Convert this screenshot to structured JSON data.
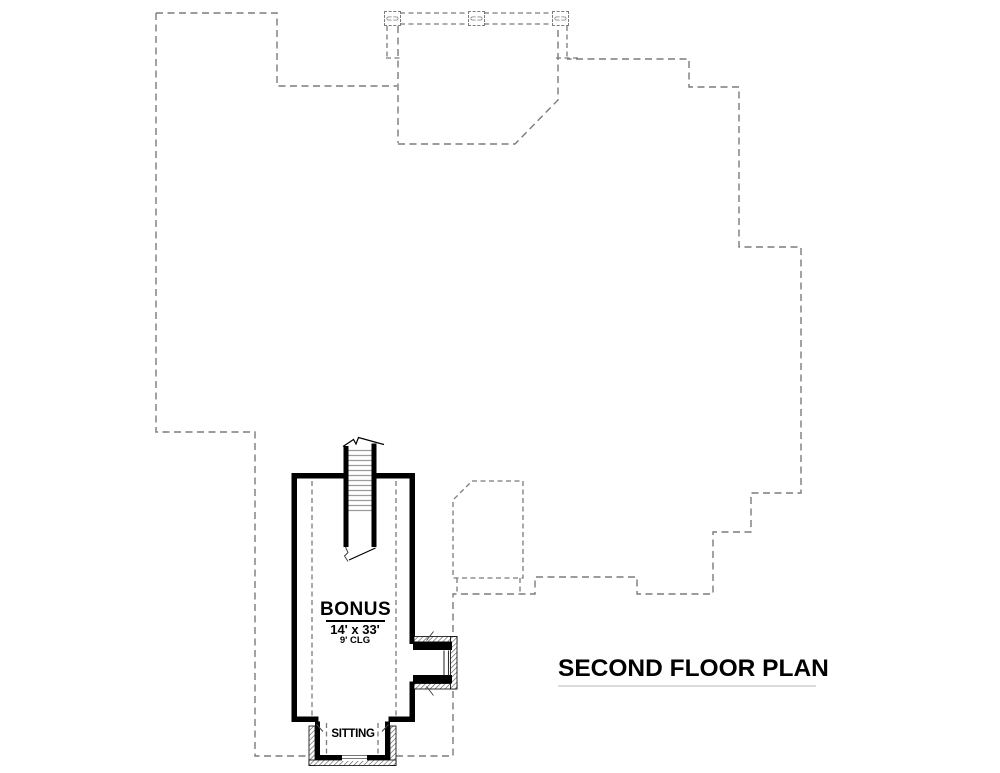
{
  "title": {
    "label": "SECOND FLOOR PLAN"
  },
  "rooms": {
    "bonus": {
      "name": "BONUS",
      "dimensions": "14' x 33'",
      "ceiling": "9' CLG"
    },
    "sitting": {
      "name": "SITTING"
    }
  },
  "symbols": {
    "roof_vent": "⊂⊃"
  },
  "colors": {
    "wall": "#000000",
    "dash": "#7b7b7b",
    "tread": "#9b9b9b",
    "hatch": "#555555",
    "glaze": "#777777",
    "tick": "#444444",
    "title_line": "#dcdcdc"
  }
}
